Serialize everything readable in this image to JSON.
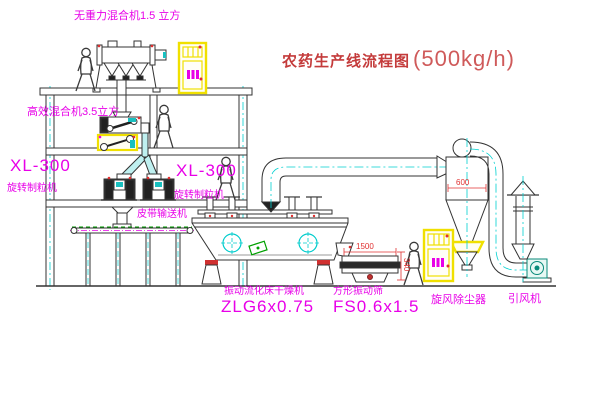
{
  "title": {
    "main": "农药生产线流程图",
    "capacity": "(500kg/h)"
  },
  "labels": {
    "gravity_mixer": "无重力混合机1.5 立方",
    "high_eff_mixer": "高效混合机3.5立方",
    "granulator_left_model": "XL-300",
    "granulator_left_name": "旋转制粒机",
    "granulator_right_model": "XL-300",
    "granulator_right_name": "旋转制粒机",
    "belt_conveyor": "皮带输送机",
    "dryer_name": "振动流化床干燥机",
    "dryer_model": "ZLG6x0.75",
    "sieve_name": "方形振动筛",
    "sieve_model": "FS0.6x1.5",
    "cyclone": "旋风除尘器",
    "fan": "引风机"
  },
  "dimensions": {
    "cyclone_diameter": "600",
    "sieve_length": "1500",
    "sieve_height": "340"
  },
  "colors": {
    "label_magenta": "#e800e8",
    "title_red": "#c43b3b",
    "dimension_red": "#e03030",
    "highlight_yellow": "#f0e000",
    "centerline_cyan": "#00d0d0",
    "line_dark": "#333333",
    "belt_green": "#00a000",
    "fan_teal": "#0a8a7a"
  }
}
